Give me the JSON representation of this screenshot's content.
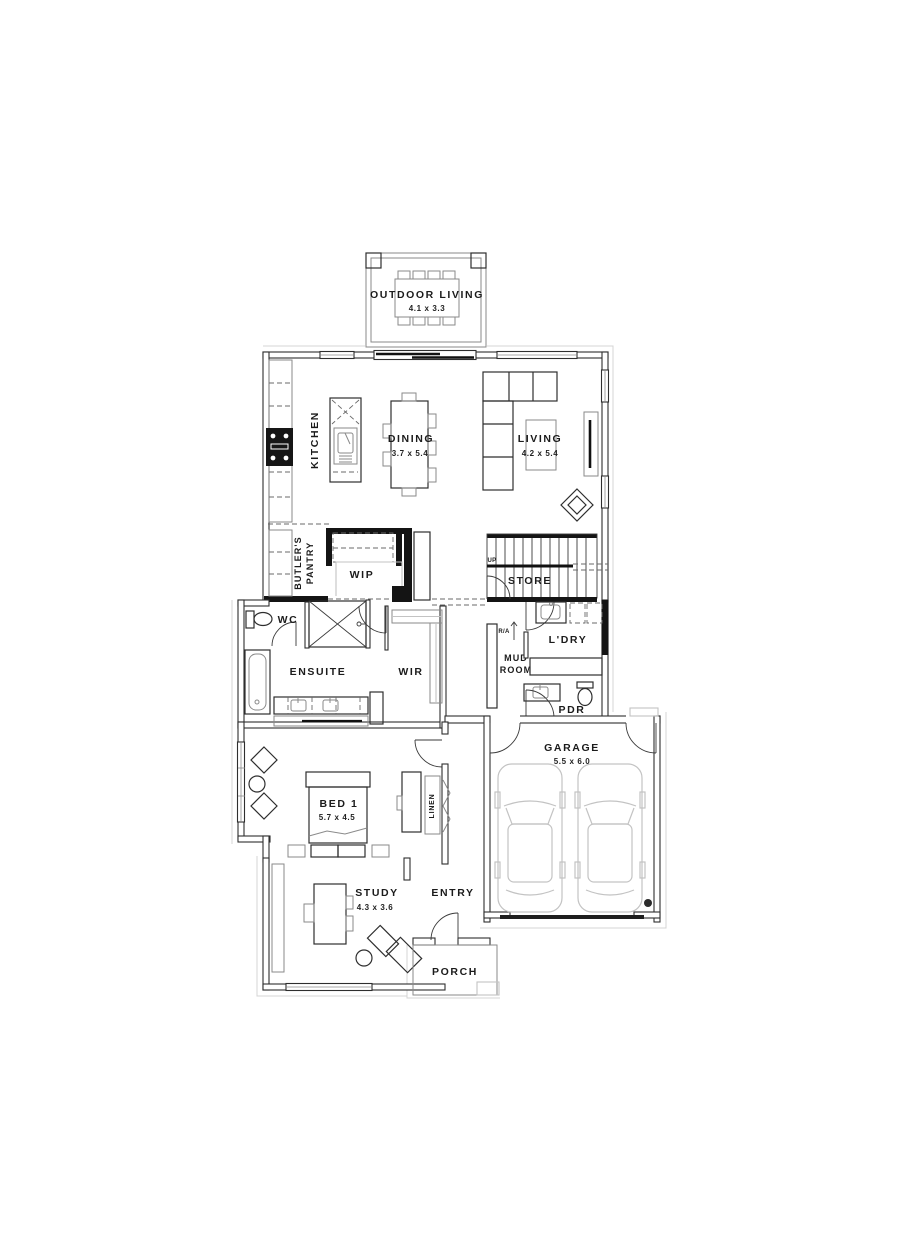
{
  "drawing": {
    "type": "residential floor plan"
  },
  "colors": {
    "background": "#ffffff",
    "wall_outline": "#2e2e2e",
    "wall_solid": "#141414",
    "furniture": "#2e2e2e",
    "furniture_light": "#8a8a8a",
    "vehicle_light": "#c3c3c3",
    "text": "#1b1b1b"
  },
  "rooms": {
    "outdoor_living": {
      "label": "OUTDOOR LIVING",
      "dims": "4.1 x 3.3"
    },
    "kitchen": {
      "label": "KITCHEN"
    },
    "dining": {
      "label": "DINING",
      "dims": "3.7 x 5.4"
    },
    "living": {
      "label": "LIVING",
      "dims": "4.2 x 5.4"
    },
    "butlers_pantry": {
      "line1": "BUTLER'S",
      "line2": "PANTRY"
    },
    "wip": {
      "label": "WIP"
    },
    "stairs": {
      "store_label": "STORE",
      "up_label": "UP"
    },
    "wc": {
      "label": "WC"
    },
    "ensuite": {
      "label": "ENSUITE"
    },
    "wir": {
      "label": "WIR"
    },
    "mud_room": {
      "line1": "MUD",
      "line2": "ROOM",
      "return_air_label": "R/A"
    },
    "laundry": {
      "label": "L'DRY"
    },
    "pdr": {
      "label": "PDR"
    },
    "garage": {
      "label": "GARAGE",
      "dims": "5.5 x 6.0"
    },
    "bed1": {
      "label": "BED 1",
      "dims": "5.7 x 4.5"
    },
    "linen": {
      "label": "LINEN"
    },
    "study": {
      "label": "STUDY",
      "dims": "4.3 x 3.6"
    },
    "entry": {
      "label": "ENTRY"
    },
    "porch": {
      "label": "PORCH"
    }
  }
}
